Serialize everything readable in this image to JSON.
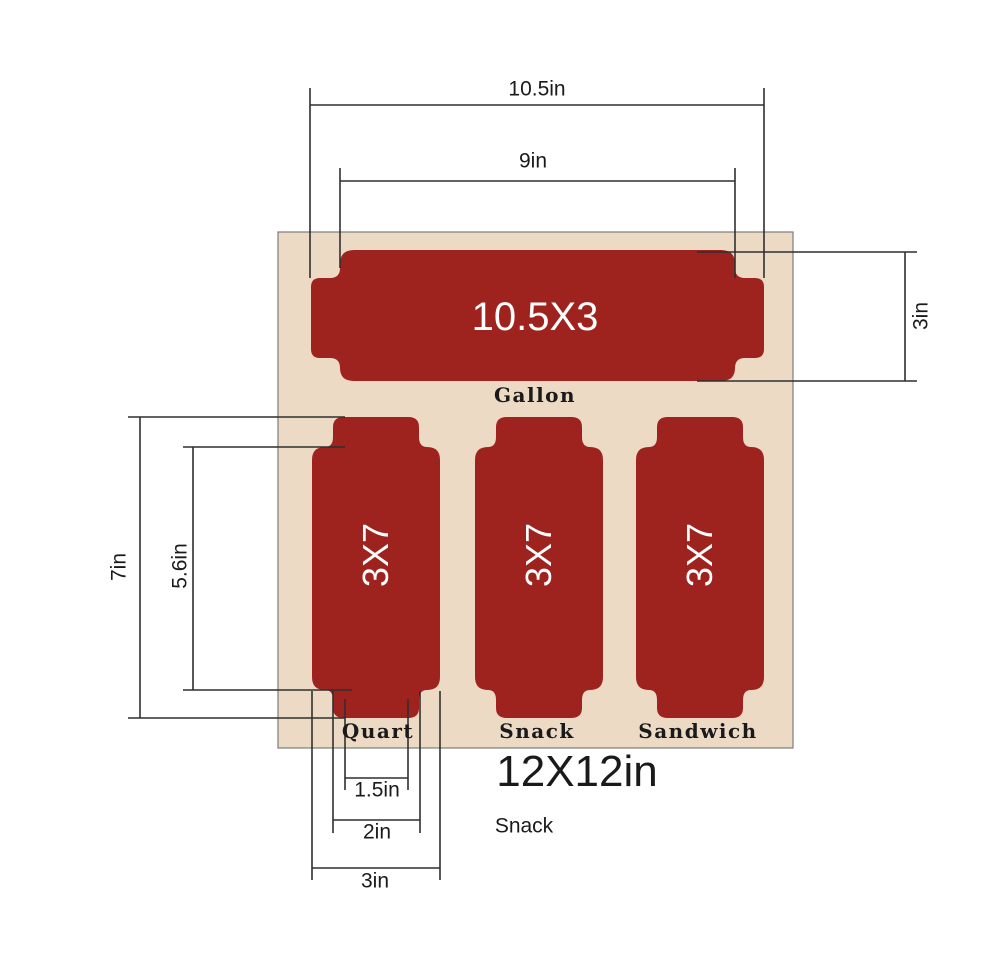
{
  "board": {
    "size_label": "12X12in",
    "caption": "Snack",
    "fill_color": "#EDDAC5",
    "border_color": "#7d7d7d"
  },
  "pockets": {
    "gallon": {
      "size": "10.5X3",
      "name": "Gallon"
    },
    "quart": {
      "size": "3X7",
      "name": "Quart"
    },
    "snack": {
      "size": "3X7",
      "name": "Snack"
    },
    "sandwich": {
      "size": "3X7",
      "name": "Sandwich"
    }
  },
  "dimensions": {
    "overall_width": "10.5in",
    "inner_width": "9in",
    "gallon_height": "3in",
    "pocket_total_height": "7in",
    "pocket_body_height": "5.6in",
    "tab_tip_width": "1.5in",
    "tab_width": "2in",
    "pocket_width": "3in"
  },
  "colors": {
    "pocket_red": "#9E221E",
    "dimension_line": "#2f2f2f",
    "text": "#1a1a1a"
  }
}
